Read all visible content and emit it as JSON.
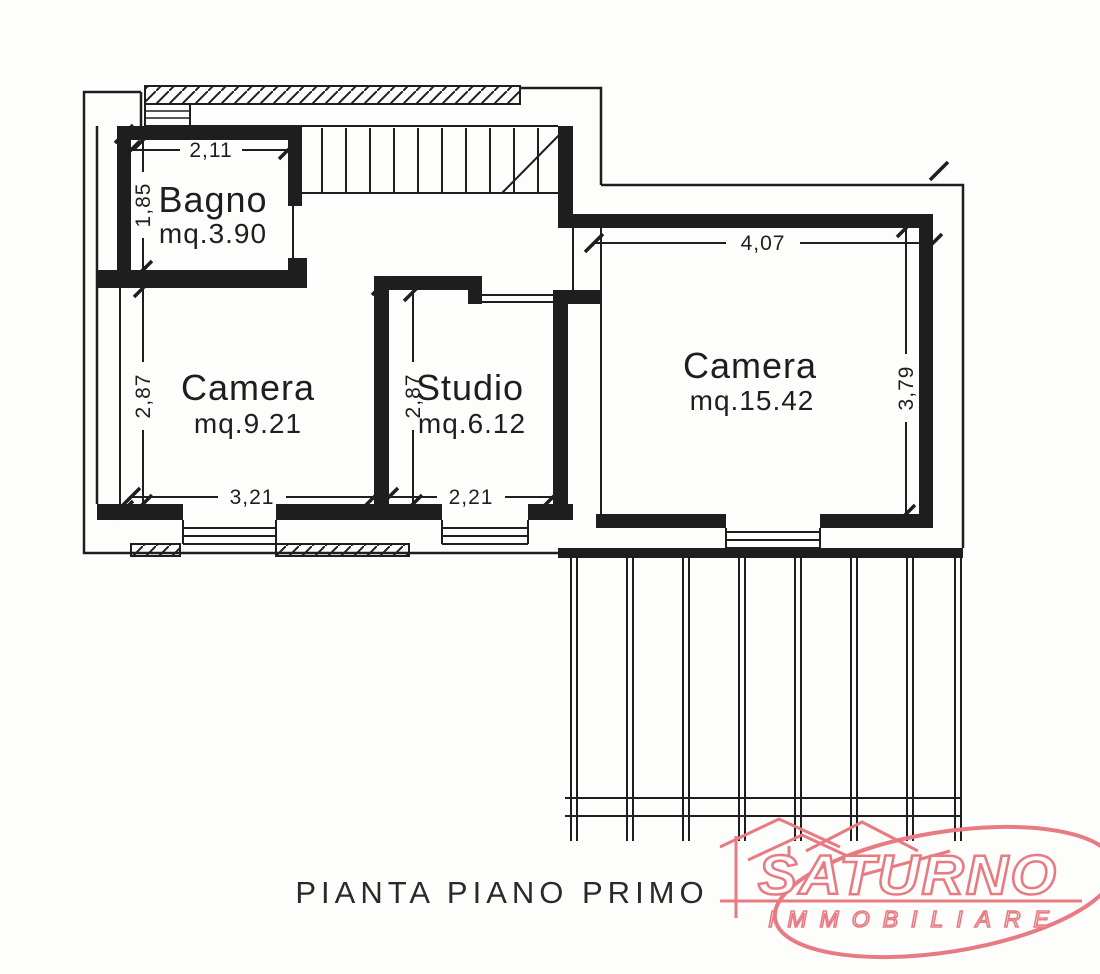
{
  "plan": {
    "title": "PIANTA PIANO PRIMO",
    "rooms": [
      {
        "name": "Bagno",
        "area": "mq.3.90",
        "dim_w": "2,11",
        "dim_h": "1,85"
      },
      {
        "name": "Camera",
        "area": "mq.9.21",
        "dim_w": "3,21",
        "dim_h": "2,87"
      },
      {
        "name": "Studio",
        "area": "mq.6.12",
        "dim_w": "2,21",
        "dim_h": "2,87"
      },
      {
        "name": "Camera",
        "area": "mq.15.42",
        "dim_w": "4,07",
        "dim_h": "3,79"
      }
    ]
  },
  "logo": {
    "brand": "SATURNO",
    "subtitle": "IMMOBILIARE",
    "color": "#e87a82"
  },
  "colors": {
    "ink": "#1e1e1e",
    "paper": "#fdfdfc"
  }
}
